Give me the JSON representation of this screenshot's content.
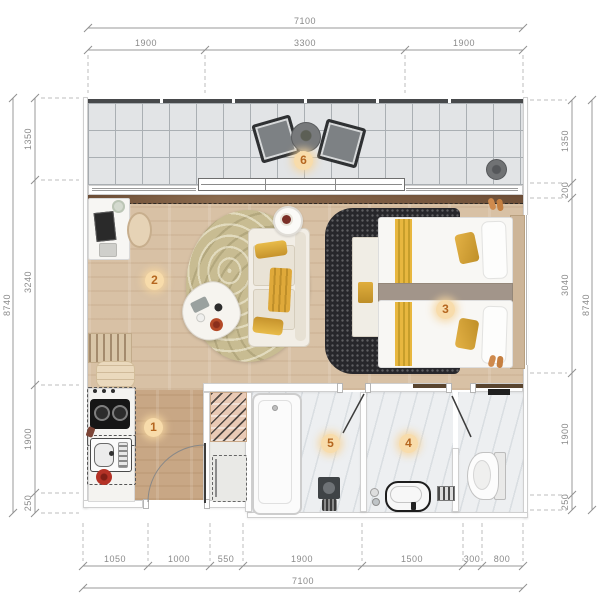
{
  "title": "studio-apartment-floor-plan",
  "dims": {
    "top": {
      "total": "7100",
      "segments": [
        "1900",
        "3300",
        "1900"
      ]
    },
    "bottom": {
      "total": "7100",
      "segments": [
        "1050",
        "1000",
        "550",
        "1900",
        "1500",
        "300",
        "800"
      ]
    },
    "left": {
      "total": "8740",
      "segments": [
        "1350",
        "3240",
        "1900",
        "250"
      ]
    },
    "right": {
      "total": "8740",
      "segments": [
        "1350",
        "200",
        "3040",
        "1900",
        "250"
      ]
    }
  },
  "rooms": {
    "kitchen": {
      "number": "1"
    },
    "living": {
      "number": "2"
    },
    "bedroom": {
      "number": "3"
    },
    "bathroom": {
      "number": "4"
    },
    "shower": {
      "number": "5"
    },
    "balcony": {
      "number": "6"
    }
  },
  "colors": {
    "badge_bg": "#f8dcab",
    "badge_text": "#b5661f",
    "gold_accent": "#dfa93a",
    "wood_floor": "#d8c1a5",
    "dark_rug": "#27272b",
    "balcony_tile": "#e2e4e6",
    "dimension_text": "#8a8a8a"
  }
}
